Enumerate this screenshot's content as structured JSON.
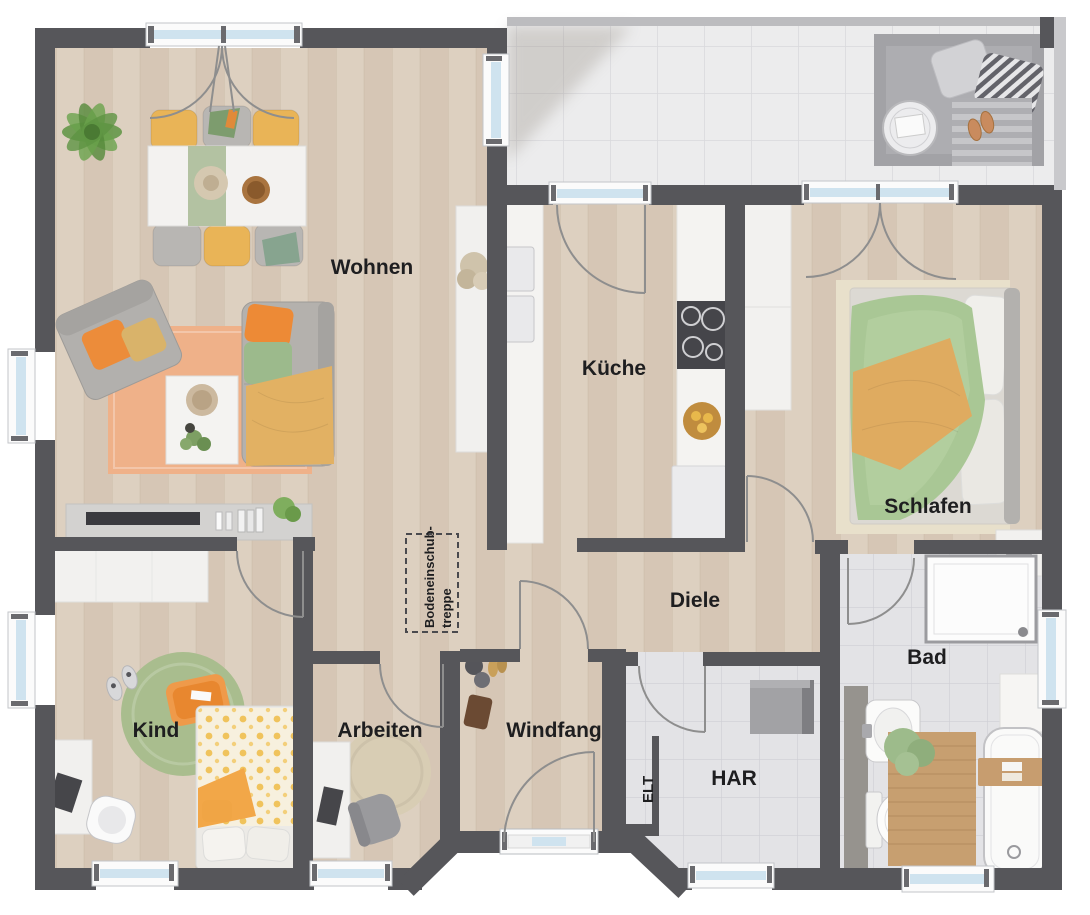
{
  "floorplan": {
    "rooms": [
      {
        "id": "wohnen",
        "label": "Wohnen"
      },
      {
        "id": "kueche",
        "label": "Küche"
      },
      {
        "id": "schlafen",
        "label": "Schlafen"
      },
      {
        "id": "diele",
        "label": "Diele"
      },
      {
        "id": "kind",
        "label": "Kind"
      },
      {
        "id": "arbeiten",
        "label": "Arbeiten"
      },
      {
        "id": "windfang",
        "label": "Windfang"
      },
      {
        "id": "elt",
        "label": "ELT"
      },
      {
        "id": "har",
        "label": "HAR"
      },
      {
        "id": "bad",
        "label": "Bad"
      }
    ],
    "annotations": {
      "attic_stairs_line1": "Bodeneinschub-",
      "attic_stairs_line2": "treppe"
    },
    "palette": {
      "wall": "#56565a",
      "wood_floor": "#dacbbb",
      "terrace_tile": "#ececed",
      "bath_tile": "#e3e3e6",
      "window_glass": "#cfe3ef",
      "window_frame": "#fbfbfb",
      "door_swing": "#8e8e8e",
      "label_text": "#1e1e20",
      "accent_orange": "#ed8a36",
      "accent_green": "#a9c795",
      "accent_yellow": "#e2b163"
    }
  }
}
